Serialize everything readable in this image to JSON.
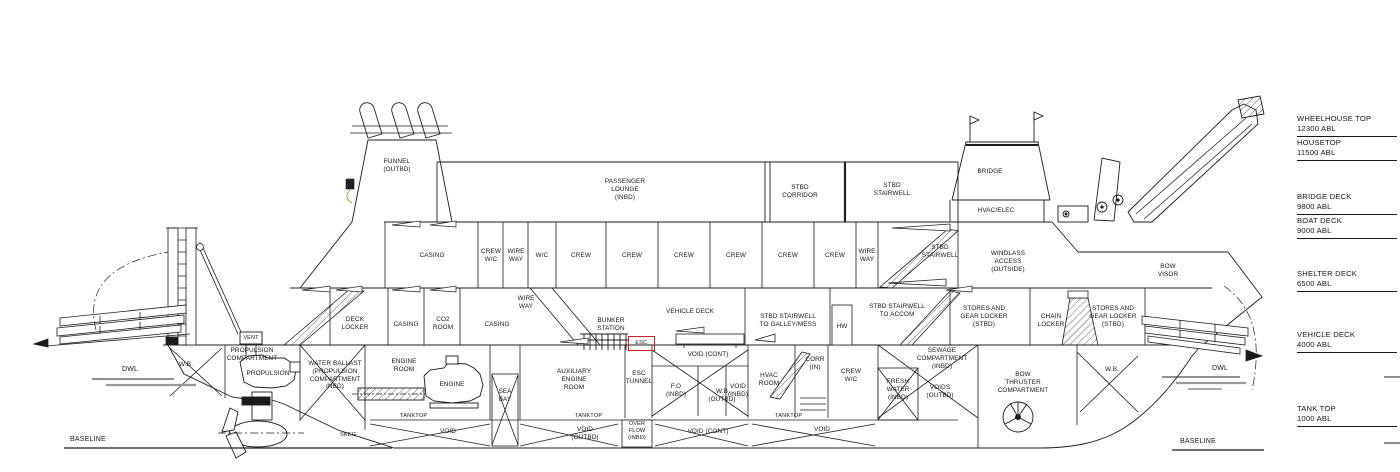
{
  "drawing_type": "ship general arrangement profile",
  "colors": {
    "line": "#1c1c1c",
    "escape_red": "#cc2222",
    "waterline_gray": "#999999"
  },
  "refs": {
    "wheelhouse_top": "WHEELHOUSE TOP\n12300 ABL",
    "housetop": "HOUSETOP\n11500 ABL",
    "bridge_deck": "BRIDGE DECK\n9800 ABL",
    "boat_deck": "BOAT DECK\n9000 ABL",
    "shelter_deck": "SHELTER DECK\n6500 ABL",
    "vehicle_deck": "VEHICLE DECK\n4000 ABL",
    "tank_top": "TANK TOP\n1000 ABL",
    "baseline": "BASELINE",
    "dwl": "DWL"
  },
  "labels": {
    "funnel": "FUNNEL\n(OUTBD)",
    "passenger_lounge": "PASSENGER\nLOUNGE\n(INBD)",
    "stbd_corridor": "STBD\nCORRIDOR",
    "stbd_stairwell": "STBD\nSTAIRWELL",
    "bridge": "BRIDGE",
    "hvac_elec": "HVAC/ELEC",
    "casing": "CASING",
    "crew_wc": "CREW\nW/C",
    "wire_way": "WIRE\nWAY",
    "wc": "W/C",
    "crew": "CREW",
    "windlass_access": "WINDLASS\nACCESS\n(OUTSIDE)",
    "bow_visor": "BOW\nVISOR",
    "deck_locker": "DECK\nLOCKER",
    "co2_room": "CO2\nROOM",
    "bunker_station": "BUNKER\nSTATION",
    "esc": "ESC.",
    "vehicle_deck": "VEHICLE DECK",
    "stbd_stairwell_galley": "STBD STAIRWELL\nTO GALLEY/MESS",
    "hw": "HW",
    "stbd_stairwell_accom": "STBD STAIRWELL\nTO ACCOM",
    "stores_gear": "STORES AND\nGEAR LOCKER\n(STBD)",
    "chain_locker": "CHAIN\nLOCKER",
    "wb": "W.B.",
    "vent": "VENT",
    "propulsion_compartment": "PROPULSION\nCOMPARTMENT",
    "propulsion": "PROPULSION",
    "water_ballast": "WATER BALLAST\n(PROPULSION\nCOMPARTMENT\nINBD)",
    "engine_room": "ENGINE\nROOM",
    "engine": "ENGINE",
    "tanktop": "TANKTOP",
    "void": "VOID",
    "sea_bay": "SEA\nBAY",
    "aux_engine_room": "AUXILIARY\nENGINE\nROOM",
    "esc_tunnel": "ESC\nTUNNEL",
    "void_cont": "VOID (CONT)",
    "fo_inbd": "F.O\n(INBD)",
    "wb_outbd": "W.B\n(OUTBD)",
    "void_inbd": "VOID\n(INBD)",
    "hvac_room": "HVAC\nROOM",
    "corr_in": "CORR\n(IN)",
    "void_outbd": "VOID\n(OUTBD)",
    "overflow_inbd": "OVER\nFLOW\n(INBD)",
    "fresh_water": "FRESH\nWATER\n(INBD)",
    "sewage": "SEWAGE\nCOMPARTMENT\n(INBD)",
    "voids_outbd": "VOIDS\n(OUTBD)",
    "bow_thruster": "BOW\nTHRUSTER\nCOMPARTMENT",
    "skeg": "SKEG"
  }
}
